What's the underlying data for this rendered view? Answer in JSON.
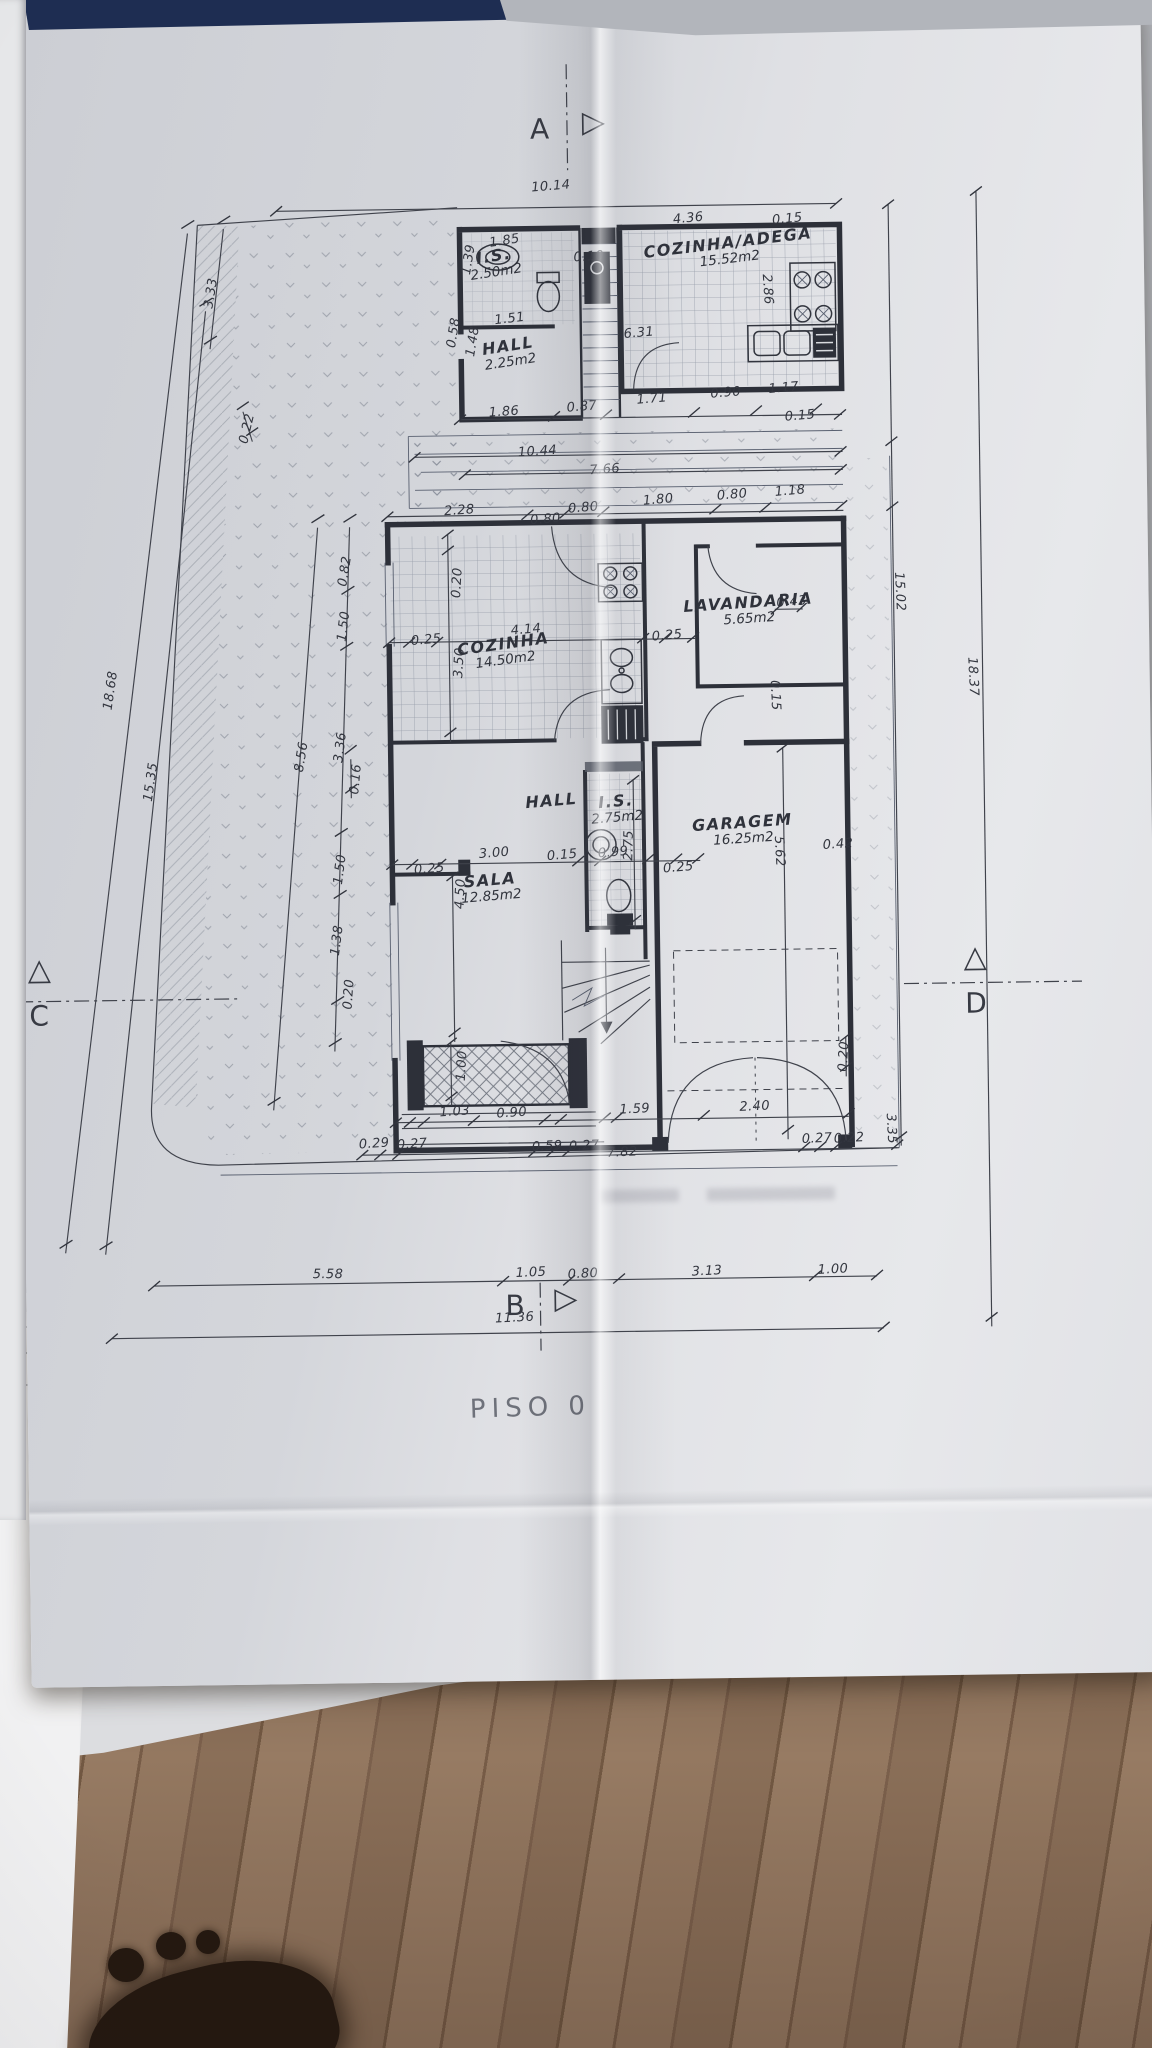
{
  "plan": {
    "title": "PISO  0",
    "markers": [
      {
        "id": "A",
        "letter": "A",
        "lx": 540,
        "ly": 112,
        "tri": "▷",
        "tx": 592,
        "ty": 108
      },
      {
        "id": "B",
        "letter": "B",
        "lx": 499,
        "ly": 1288,
        "tri": "▷",
        "tx": 548,
        "ty": 1284
      },
      {
        "id": "C",
        "letter": "C",
        "lx": 27,
        "ly": 992,
        "tri": "△",
        "tx": 26,
        "ty": 948
      },
      {
        "id": "D",
        "letter": "D",
        "lx": 963,
        "ly": 992,
        "tri": "△",
        "tx": 962,
        "ty": 948
      }
    ],
    "rooms": [
      {
        "id": "is-upper",
        "name": "I.S.",
        "area": "2.50m2",
        "x": 503,
        "y": 262,
        "rot": -8
      },
      {
        "id": "hall-upper",
        "name": "HALL",
        "area": "2.25m2",
        "x": 516,
        "y": 352,
        "rot": -8
      },
      {
        "id": "cozinha-adega",
        "name": "COZINHA/ADEGA",
        "area": "15.52m2",
        "x": 737,
        "y": 252,
        "rot": -6
      },
      {
        "id": "cozinha",
        "name": "COZINHA",
        "area": "14.50m2",
        "x": 507,
        "y": 650,
        "rot": -7
      },
      {
        "id": "lavandaria",
        "name": "LAVANDARIA",
        "area": "5.65m2",
        "x": 752,
        "y": 612,
        "rot": -3
      },
      {
        "id": "hall-mid",
        "name": "HALL",
        "area": "",
        "x": 552,
        "y": 800,
        "rot": -4
      },
      {
        "id": "is-mid",
        "name": "I.S.",
        "area": "2.75m2",
        "x": 617,
        "y": 809,
        "rot": -4
      },
      {
        "id": "sala",
        "name": "SALA",
        "area": "12.85m2",
        "x": 490,
        "y": 886,
        "rot": -4
      },
      {
        "id": "garagem",
        "name": "GARAGEM",
        "area": "16.25m2",
        "x": 743,
        "y": 832,
        "rot": -3
      }
    ],
    "dimensions": [
      {
        "t": "10.14",
        "x": 560,
        "y": 186,
        "r": -4
      },
      {
        "t": "4.36",
        "x": 697,
        "y": 220,
        "r": -5
      },
      {
        "t": "0.15",
        "x": 796,
        "y": 222,
        "r": -5
      },
      {
        "t": "0.10",
        "x": 597,
        "y": 257,
        "r": -3
      },
      {
        "t": "6.31",
        "x": 646,
        "y": 334,
        "r": -4
      },
      {
        "t": "2.86",
        "x": 775,
        "y": 292,
        "r": 87
      },
      {
        "t": "1.39",
        "x": 477,
        "y": 258,
        "r": -80
      },
      {
        "t": "1.85",
        "x": 513,
        "y": 240,
        "r": -8
      },
      {
        "t": "1.51",
        "x": 517,
        "y": 318,
        "r": -6
      },
      {
        "t": "0.58",
        "x": 461,
        "y": 331,
        "r": -80
      },
      {
        "t": "1.48",
        "x": 480,
        "y": 340,
        "r": -80
      },
      {
        "t": "1.86",
        "x": 510,
        "y": 411,
        "r": -3
      },
      {
        "t": "0.87",
        "x": 588,
        "y": 407,
        "r": -4
      },
      {
        "t": "1.71",
        "x": 658,
        "y": 400,
        "r": -4
      },
      {
        "t": "0.90",
        "x": 732,
        "y": 395,
        "r": -4
      },
      {
        "t": "1.17",
        "x": 790,
        "y": 391,
        "r": -4
      },
      {
        "t": "0.15",
        "x": 806,
        "y": 419,
        "r": -4
      },
      {
        "t": "10.44",
        "x": 543,
        "y": 451,
        "r": -3
      },
      {
        "t": "7.66",
        "x": 610,
        "y": 470,
        "r": -3
      },
      {
        "t": "2.28",
        "x": 464,
        "y": 509,
        "r": -3
      },
      {
        "t": "0.80",
        "x": 550,
        "y": 519,
        "r": -4
      },
      {
        "t": "0.80",
        "x": 588,
        "y": 508,
        "r": -4
      },
      {
        "t": "1.80",
        "x": 663,
        "y": 501,
        "r": -4
      },
      {
        "t": "0.80",
        "x": 737,
        "y": 497,
        "r": -4
      },
      {
        "t": "1.18",
        "x": 795,
        "y": 494,
        "r": -4
      },
      {
        "t": "0.20",
        "x": 461,
        "y": 581,
        "r": -86
      },
      {
        "t": "4.14",
        "x": 529,
        "y": 629,
        "r": -4
      },
      {
        "t": "0.25",
        "x": 429,
        "y": 638,
        "r": -4
      },
      {
        "t": "3.50",
        "x": 462,
        "y": 661,
        "r": -86
      },
      {
        "t": "0.25",
        "x": 670,
        "y": 637,
        "r": -4
      },
      {
        "t": "0.43",
        "x": 795,
        "y": 605,
        "r": -4
      },
      {
        "t": "15.02",
        "x": 903,
        "y": 596,
        "r": 88
      },
      {
        "t": "0.15",
        "x": 777,
        "y": 698,
        "r": 88
      },
      {
        "t": "3.00",
        "x": 494,
        "y": 852,
        "r": -4
      },
      {
        "t": "0.15",
        "x": 562,
        "y": 855,
        "r": -4
      },
      {
        "t": "0.99",
        "x": 613,
        "y": 853,
        "r": -4
      },
      {
        "t": "2.75",
        "x": 629,
        "y": 846,
        "r": -88
      },
      {
        "t": "0.25",
        "x": 429,
        "y": 867,
        "r": -4
      },
      {
        "t": "0.25",
        "x": 678,
        "y": 869,
        "r": -4
      },
      {
        "t": "4.50",
        "x": 460,
        "y": 892,
        "r": -86
      },
      {
        "t": "5.62",
        "x": 779,
        "y": 854,
        "r": 88
      },
      {
        "t": "0.42",
        "x": 838,
        "y": 848,
        "r": -3
      },
      {
        "t": "0.16",
        "x": 357,
        "y": 776,
        "r": -84
      },
      {
        "t": "3.33",
        "x": 219,
        "y": 288,
        "r": -80
      },
      {
        "t": "0.22",
        "x": 253,
        "y": 424,
        "r": -76
      },
      {
        "t": "18.68",
        "x": 113,
        "y": 684,
        "r": -81
      },
      {
        "t": "15.35",
        "x": 152,
        "y": 776,
        "r": -81
      },
      {
        "t": "8.56",
        "x": 303,
        "y": 753,
        "r": -80
      },
      {
        "t": "3.36",
        "x": 342,
        "y": 744,
        "r": -82
      },
      {
        "t": "0.82",
        "x": 349,
        "y": 568,
        "r": -80
      },
      {
        "t": "1.50",
        "x": 347,
        "y": 623,
        "r": -82
      },
      {
        "t": "1.50",
        "x": 340,
        "y": 866,
        "r": -82
      },
      {
        "t": "1.38",
        "x": 336,
        "y": 937,
        "r": -82
      },
      {
        "t": "0.20",
        "x": 347,
        "y": 991,
        "r": -85
      },
      {
        "t": "1.00",
        "x": 459,
        "y": 1064,
        "r": -86
      },
      {
        "t": "0.20",
        "x": 841,
        "y": 1060,
        "r": -86
      },
      {
        "t": "1.03",
        "x": 451,
        "y": 1110,
        "r": -3
      },
      {
        "t": "0.90",
        "x": 508,
        "y": 1112,
        "r": -3
      },
      {
        "t": "1.59",
        "x": 631,
        "y": 1110,
        "r": -2
      },
      {
        "t": "2.40",
        "x": 751,
        "y": 1109,
        "r": -2
      },
      {
        "t": "0.29",
        "x": 370,
        "y": 1141,
        "r": -3
      },
      {
        "t": "0.27",
        "x": 408,
        "y": 1142,
        "r": -3
      },
      {
        "t": "0.59",
        "x": 543,
        "y": 1146,
        "r": -2
      },
      {
        "t": "0.27",
        "x": 580,
        "y": 1146,
        "r": -2
      },
      {
        "t": "7.82",
        "x": 618,
        "y": 1153,
        "r": -2
      },
      {
        "t": "0.27",
        "x": 813,
        "y": 1142,
        "r": -2
      },
      {
        "t": "0.22",
        "x": 845,
        "y": 1142,
        "r": -2
      },
      {
        "t": "3.35",
        "x": 887,
        "y": 1133,
        "r": 88
      },
      {
        "t": "5.58",
        "x": 322,
        "y": 1271,
        "r": 1
      },
      {
        "t": "1.05",
        "x": 525,
        "y": 1272,
        "r": -2
      },
      {
        "t": "0.80",
        "x": 577,
        "y": 1274,
        "r": -2
      },
      {
        "t": "3.13",
        "x": 701,
        "y": 1273,
        "r": -2
      },
      {
        "t": "1.00",
        "x": 827,
        "y": 1273,
        "r": -2
      },
      {
        "t": "11.36",
        "x": 508,
        "y": 1317,
        "r": -2
      },
      {
        "t": "18.37",
        "x": 975,
        "y": 682,
        "r": 88
      }
    ]
  }
}
